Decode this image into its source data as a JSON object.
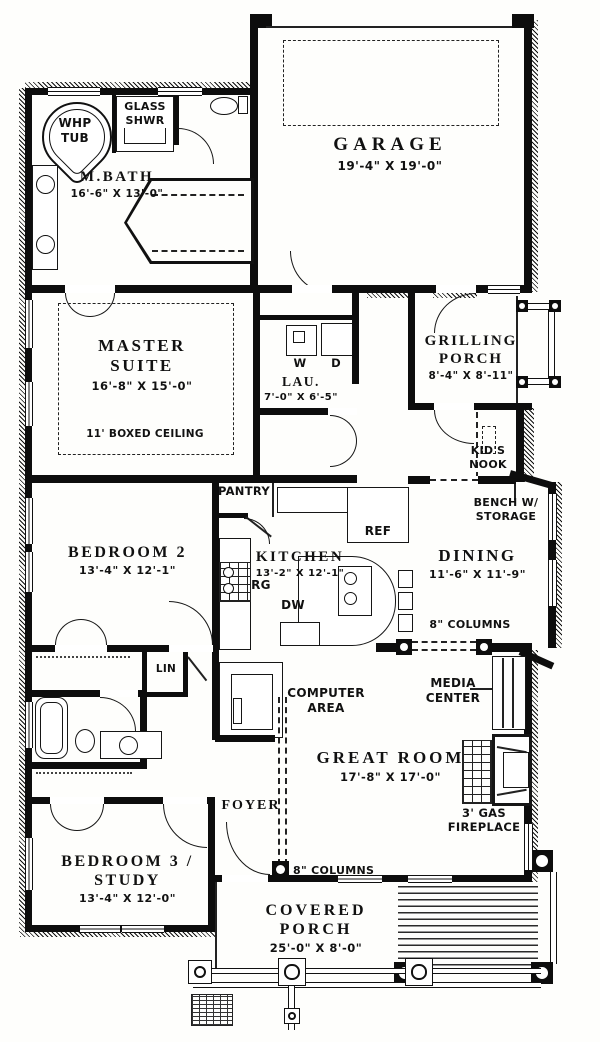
{
  "rooms": {
    "mbath": {
      "name": "M.BATH",
      "dims": "16'-6\" X 13'-0\""
    },
    "garage": {
      "name": "GARAGE",
      "dims": "19'-4\" X 19'-0\""
    },
    "master": {
      "name": "MASTER\nSUITE",
      "dims": "16'-8\" X 15'-0\"",
      "note": "11' BOXED CEILING"
    },
    "laundry": {
      "name": "LAU.",
      "dims": "7'-0\" X 6'-5\""
    },
    "grilling_porch": {
      "name": "GRILLING\nPORCH",
      "dims": "8'-4\" X 8'-11\""
    },
    "kitchen": {
      "name": "KITCHEN",
      "dims": "13'-2\" X 12'-1\""
    },
    "dining": {
      "name": "DINING",
      "dims": "11'-6\" X 11'-9\""
    },
    "bedroom2": {
      "name": "BEDROOM 2",
      "dims": "13'-4\" X 12'-1\""
    },
    "great_room": {
      "name": "GREAT ROOM",
      "dims": "17'-8\" X 17'-0\""
    },
    "foyer": {
      "name": "FOYER"
    },
    "bedroom3": {
      "name": "BEDROOM 3 /\nSTUDY",
      "dims": "13'-4\" X 12'-0\""
    },
    "covered_porch": {
      "name": "COVERED\nPORCH",
      "dims": "25'-0\" X 8'-0\""
    }
  },
  "fixtures": {
    "whp_tub": "WHP\nTUB",
    "glass_shower": "GLASS\nSHWR",
    "washer": "W",
    "dryer": "D",
    "pantry": "PANTRY",
    "refrigerator": "REF",
    "range": "RG",
    "dishwasher": "DW",
    "linen": "LIN",
    "kids_nook": "KID'S\nNOOK",
    "bench_storage": "BENCH W/\nSTORAGE",
    "computer_area": "COMPUTER\nAREA",
    "media_center": "MEDIA\nCENTER",
    "fireplace": "3' GAS\nFIREPLACE",
    "columns_dining": "8\" COLUMNS",
    "columns_foyer": "8\" COLUMNS"
  }
}
